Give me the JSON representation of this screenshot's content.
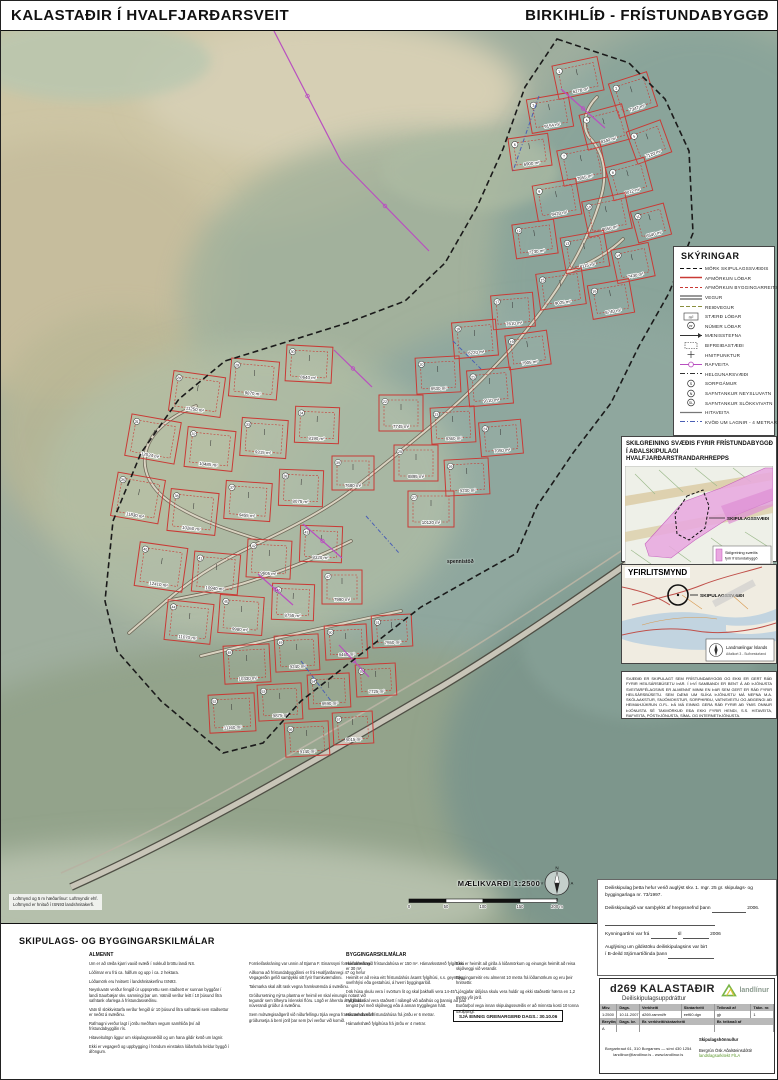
{
  "header": {
    "title_left": "KALASTAÐIR  Í  HVALFJARÐARSVEIT",
    "title_right": "BIRKIHLÍÐ - FRÍSTUNDABYGGÐ"
  },
  "map": {
    "caption_line1": "Loftmynd og 5 m hæðarlínur: Loftmyndir ehf.",
    "caption_line2": "Loftmynd er hnituð í ISN93 landshnitakerfi.",
    "road_label": "spennistöð",
    "plots": [
      [
        1,
        577,
        77,
        46,
        34,
        -12,
        "6278 m²"
      ],
      [
        2,
        632,
        94,
        40,
        36,
        -18,
        "7347 m²"
      ],
      [
        3,
        549,
        112,
        42,
        34,
        -10,
        "9154 m²"
      ],
      [
        4,
        604,
        126,
        44,
        36,
        -15,
        "8340 m²"
      ],
      [
        5,
        648,
        141,
        36,
        34,
        -20,
        "7120 m²"
      ],
      [
        6,
        529,
        151,
        40,
        32,
        -8,
        "6900 m²"
      ],
      [
        7,
        581,
        163,
        44,
        36,
        -12,
        "7855 m²"
      ],
      [
        8,
        628,
        178,
        40,
        34,
        -15,
        "8012 m²"
      ],
      [
        9,
        556,
        199,
        44,
        36,
        -10,
        "9420 m²"
      ],
      [
        10,
        606,
        214,
        44,
        36,
        -12,
        "8650 m²"
      ],
      [
        11,
        650,
        222,
        34,
        32,
        -15,
        "6540 m²"
      ],
      [
        12,
        534,
        238,
        42,
        34,
        -8,
        "7230 m²"
      ],
      [
        13,
        584,
        251,
        44,
        36,
        -10,
        "8115 m²"
      ],
      [
        14,
        632,
        262,
        38,
        34,
        -12,
        "7430 m²"
      ],
      [
        15,
        560,
        288,
        46,
        36,
        -8,
        "9025 m²"
      ],
      [
        16,
        610,
        298,
        42,
        34,
        -10,
        "8740 m²"
      ],
      [
        17,
        512,
        310,
        42,
        34,
        -5,
        "7610 m²"
      ],
      [
        18,
        474,
        338,
        44,
        36,
        -5,
        "8220 m²"
      ],
      [
        19,
        527,
        349,
        42,
        34,
        -8,
        "7905 m²"
      ],
      [
        20,
        437,
        374,
        44,
        36,
        -3,
        "8530 m²"
      ],
      [
        21,
        489,
        386,
        44,
        36,
        -5,
        "9110 m²"
      ],
      [
        22,
        400,
        412,
        44,
        36,
        0,
        "7745 m²"
      ],
      [
        23,
        452,
        424,
        44,
        36,
        -3,
        "8360 m²"
      ],
      [
        24,
        500,
        437,
        42,
        34,
        -5,
        "7050 m²"
      ],
      [
        25,
        415,
        462,
        44,
        36,
        0,
        "8895 m²"
      ],
      [
        26,
        466,
        476,
        44,
        36,
        -3,
        "9230 m²"
      ],
      [
        27,
        430,
        508,
        46,
        36,
        0,
        "10120 m²"
      ],
      [
        28,
        196,
        393,
        52,
        40,
        8,
        "11250 m²"
      ],
      [
        29,
        253,
        378,
        48,
        38,
        5,
        "9870 m²"
      ],
      [
        30,
        308,
        363,
        46,
        36,
        3,
        "8640 m²"
      ],
      [
        31,
        152,
        438,
        50,
        42,
        10,
        "12024 m²"
      ],
      [
        32,
        209,
        448,
        48,
        40,
        6,
        "10485 m²"
      ],
      [
        33,
        263,
        437,
        46,
        38,
        4,
        "9315 m²"
      ],
      [
        34,
        316,
        424,
        44,
        36,
        2,
        "8190 m²"
      ],
      [
        35,
        137,
        497,
        48,
        44,
        10,
        "11830 m²"
      ],
      [
        36,
        192,
        511,
        48,
        42,
        6,
        "10260 m²"
      ],
      [
        37,
        247,
        500,
        46,
        38,
        4,
        "9455 m²"
      ],
      [
        38,
        300,
        487,
        44,
        36,
        2,
        "8075 m²"
      ],
      [
        39,
        352,
        472,
        42,
        34,
        0,
        "7680 m²"
      ],
      [
        40,
        160,
        566,
        48,
        44,
        8,
        "12410 m²"
      ],
      [
        41,
        215,
        572,
        46,
        40,
        5,
        "10940 m²"
      ],
      [
        42,
        268,
        558,
        44,
        38,
        3,
        "9605 m²"
      ],
      [
        43,
        320,
        543,
        42,
        36,
        2,
        "8320 m²"
      ],
      [
        44,
        188,
        621,
        46,
        40,
        6,
        "11070 m²"
      ],
      [
        45,
        240,
        614,
        44,
        38,
        4,
        "9980 m²"
      ],
      [
        46,
        292,
        601,
        42,
        36,
        2,
        "8755 m²"
      ],
      [
        47,
        341,
        586,
        40,
        34,
        0,
        "7990 m²"
      ],
      [
        48,
        246,
        663,
        46,
        38,
        -3,
        "10330 m²"
      ],
      [
        49,
        296,
        652,
        44,
        36,
        -3,
        "9240 m²"
      ],
      [
        50,
        345,
        641,
        42,
        34,
        -3,
        "8460 m²"
      ],
      [
        51,
        391,
        630,
        40,
        32,
        -3,
        "7550 m²"
      ],
      [
        52,
        231,
        712,
        46,
        38,
        -3,
        "11160 m²"
      ],
      [
        53,
        279,
        701,
        44,
        36,
        -3,
        "9875 m²"
      ],
      [
        54,
        328,
        690,
        42,
        34,
        -3,
        "8590 m²"
      ],
      [
        55,
        375,
        679,
        40,
        32,
        -3,
        "7725 m²"
      ],
      [
        56,
        306,
        738,
        44,
        34,
        -3,
        "9140 m²"
      ],
      [
        57,
        352,
        727,
        40,
        32,
        -3,
        "8015 m²"
      ]
    ],
    "power_lines": [
      [
        273,
        30,
        340,
        160
      ],
      [
        340,
        160,
        428,
        250
      ],
      [
        560,
        88,
        604,
        127
      ],
      [
        333,
        349,
        371,
        386
      ],
      [
        302,
        523,
        341,
        557
      ],
      [
        257,
        573,
        292,
        604
      ],
      [
        338,
        644,
        368,
        676
      ]
    ],
    "utility_lines": [
      [
        538,
        95,
        512,
        170
      ],
      [
        365,
        515,
        398,
        552
      ],
      [
        300,
        660,
        330,
        700
      ],
      [
        452,
        340,
        480,
        368
      ]
    ]
  },
  "legend": {
    "title": "SKÝRINGAR",
    "items": [
      {
        "sym": "boundary",
        "label": "MÖRK SKIPULAGSSVÆÐIS"
      },
      {
        "sym": "lot",
        "label": "AFMÖRKUN LÓÐAR"
      },
      {
        "sym": "bldg",
        "label": "AFMÖRKUN BYGGINGARREITS"
      },
      {
        "sym": "road",
        "label": "VEGUR"
      },
      {
        "sym": "riding",
        "label": "REIÐVEGUR"
      },
      {
        "sym": "size",
        "label": "STÆRÐ LÓÐAR"
      },
      {
        "sym": "lotnum",
        "label": "NÚMER LÓÐAR"
      },
      {
        "sym": "ridge",
        "label": "MÆNISSTEFNA"
      },
      {
        "sym": "parking",
        "label": "BIFREIÐASTÆÐI"
      },
      {
        "sym": "point",
        "label": "HNITPUNKTUR"
      },
      {
        "sym": "power",
        "label": "RAFVEITA"
      },
      {
        "sym": "easement",
        "label": "HELGUNARSVÆÐI"
      },
      {
        "sym": "waste",
        "label": "SORPGÁMUR"
      },
      {
        "sym": "tankn",
        "label": "SAFNTANKUR NEYSLUVATN"
      },
      {
        "sym": "tanks",
        "label": "SAFNTANKUR SLÖKKVIVATN"
      },
      {
        "sym": "heat",
        "label": "HITAVEITA"
      },
      {
        "sym": "pipes",
        "label": "KVÖÐ UM LAGNIR - 4 METRAR"
      }
    ]
  },
  "inset_landuse": {
    "title": "SKILGREINING SVÆÐIS FYRIR FRÍSTUNDABYGGÐ Í AÐALSKIPULAGI HVALFJARÐARSTRANDARHREPPS",
    "area_label": "SKIPULAGSSVÆÐI",
    "legend_label": "Skilgreining svæðis fyrir frístundabyggð"
  },
  "inset_overview": {
    "title": "YFIRLITSMYND",
    "area_label": "SKIPULAGSSVÆÐI",
    "credit1": "Landmælingar Íslands",
    "credit2": "Aðalkort 3 - Suðvesturland"
  },
  "notice": {
    "text": "SVÆÐIÐ ER SKIPULAGT SEM FRÍSTUNDABYGGÐ OG EKKI ER GERT RÁÐ FYRIR HEILSÁRSBÚSETU ÞAR. Í ÞVÍ SAMBANDI ER BENT Á AÐ ÞJÓNUSTA SVEITARFÉLAGSINS ER ALMENNT MINNI EN ÞAR SEM GERT ER RÁÐ FYRIR HEILSÁRSBÚSETU. SEM DÆMI UM SLÍKA ÞJÓNUSTU MÁ NEFNA M.A. SKÓLAAKSTUR, SNJÓMOKSTUR, SORPHIRÐU, VATNSVEITU OG AÐGENGI AÐ HEIMAHJÚKRUN O.FL. ÞÁ MÁ EINNIG GERA RÁÐ FYRIR AÐ ÝMIS ÖNNUR ÞJÓNUSTA SÉ TAKMÖRKUÐ EÐA EKKI FYRIR HENDI, S.S. HITAVEITA, RAFVEITA, PÓSTÞJÓNUSTA, SÍMA- OG INTERNETÞJÓNUSTA."
  },
  "scalebar": {
    "label": "MÆLIKVARÐI 1:2500",
    "ticks": [
      "0",
      "50",
      "100",
      "150",
      "200 m"
    ]
  },
  "approval": {
    "line1": "Deiliskipulag þetta hefur verið auglýst skv. 1. mgr. 25 gr. skipulags- og byggingarlaga nr. 73/1997.",
    "samthykkt_pre": "Deiliskipulagið var samþykkt af hreppsnefnd þann",
    "samthykkt_post": "2006.",
    "kynning_pre": "Kynningartími var frá",
    "kynning_mid": "til",
    "kynning_post": "2006",
    "gildistaka_l1": "Auglýsing um gildistöku deiliskipulagsins var birt",
    "gildistaka_l2": "í B-deild Stjórnartíðinda þann"
  },
  "terms": {
    "heading": "SKIPULAGS- OG BYGGINGARSKILMÁLAR",
    "col1_heading": "ALMENNT",
    "col3_heading": "BYGGINGARSKILMÁLAR",
    "col1": [
      "Um er að ræða kjarri vaxið svæði í nokkuð bröttu landi NS.",
      "Lóðirnar eru frá ca. hálfum og upp í ca. 2 hektara.",
      "Lóðamörk eru hnitsett í landshnitakerfinu ISN93.",
      "Neysluvatn verður fengið úr uppsprettu sem staðsett er sunnan byggðar í landi Saurbæjar skv. samningi þar um. Vatnið verður leitt í 10 þúsund lítra safntank ofarlega á frístundasvæðinu.",
      "Vatn til slökkvistarfa verður fengið úr 10 þúsund lítra safntanki sem staðsettur er neðst á svæðinu.",
      "Rafmagni verður lagt í jörðu meðfram vegum samhliða því að frístundabyggðin rís.",
      "Hitaveitulögn liggur um skipulagssvæðið og um hana gildir kvöð um lagnir.",
      "Ekki er vegagerð og uppbygging í höndum einstakra lóðarhafa heldur byggð í áföngum."
    ],
    "col2": [
      "Fornleifaskráning var unnin af Bjarna F. Einarssyni fornleifafræðingi.",
      "Aðkoma að frístundabyggðinni er frá Hvalfjarðarvegi 47 og hefur Vegagerðin gefið samþykki sitt fyrir framkvæmdinni.",
      "Takmarka skal allt rask vegna framkvæmda á svæðinu.",
      "Gróðursetning nýrra plantna er heimil en skal einungis notast við tegundir sem tilheyra íslenskri flóru. Lögð er áhersla á að halda í núverandi gróður á svæðinu.",
      "Sem mótvægisaðgerð við niðurfellingu trjáa vegna framkvæmda skal gróðursetja á berri jörð þar sem því verður við komið."
    ],
    "col3": [
      "Hámarksstærð frístundahúsa er 150 m². Hámarksstærð fylgihúsa er 30 m².",
      "Heimilt er að reisa eitt frístundahús ásamt fylgihúsi, s.s. geymslu, svefnhýsi eða gestahúsi, á hverri byggingarlóð.",
      "Þök húsa skulu vera í svörtum lit og skal þakhalli vera 14-45°.",
      "Fylgihús skal vera staðsett í nálægð við aðalhús og þannig að það tengist því með skjólvegg eða á annan tryggilegan hátt.",
      "Hámarkshæð frístundahúsa frá jörðu er 6 metrar.",
      "Hámarkshæð fylgihúsa frá jörðu er 4 metrar."
    ],
    "col4": [
      "Ekki er heimilt að girða á lóðamörkum og einungis heimilt að reisa skjólveggi við verandir.",
      "Byggingarreitir eru almennt 10 metra frá lóðamörkum og eru þeir hnitsettir.",
      "Ljósgjafar útiljósa skulu vera huldir og ekki staðsettir hærra en 1,2 metra yfir jörð.",
      "Burðarþol vega innan skipulagssvæðis er að minnsta kosti 10 tonna öxulþungi."
    ],
    "see_also": "SJÁ EINNIG GREINARGERÐ DAGS.: 30.10.06"
  },
  "titleblock": {
    "title": "d269 KALASTAÐIR",
    "subtitle": "Deiliskipulagsuppdráttur",
    "logo_text": "landlínur",
    "headers1": [
      "Mkv.",
      "Dags.",
      "Verkheiti",
      "Skráarheiti",
      "Teiknað af",
      "Tákn. nr."
    ],
    "values1": [
      "1:2500",
      "10.11.2007",
      "d269-rammi/fr",
      "eef60.dgn",
      "gþ",
      "1"
    ],
    "headers2": [
      "Breyting",
      "Dags. br.",
      "Br. verkheiti/skráarheiti",
      "Br. teiknað af"
    ],
    "values2": [
      "A",
      "",
      "",
      ""
    ],
    "address1": "Borgarbraut 61, 310 Borgarnes — sími 430 1254",
    "address2": "landlinur@landlinur.is - www.landlinur.is",
    "designer_label": "Skipulagshönnuður",
    "designer_name": "Bergrún Ósk Aðalsteinsdóttir",
    "designer_title": "landslagsarkitekt FÍLA"
  },
  "colors": {
    "lot_red": "#c93a35",
    "power_magenta": "#b94fc0",
    "utility_blue": "#4a5fb5",
    "boundary_black": "#1a1a1a",
    "landuse_pink": "#e9a8e0",
    "logo_green": "#7ab648"
  }
}
